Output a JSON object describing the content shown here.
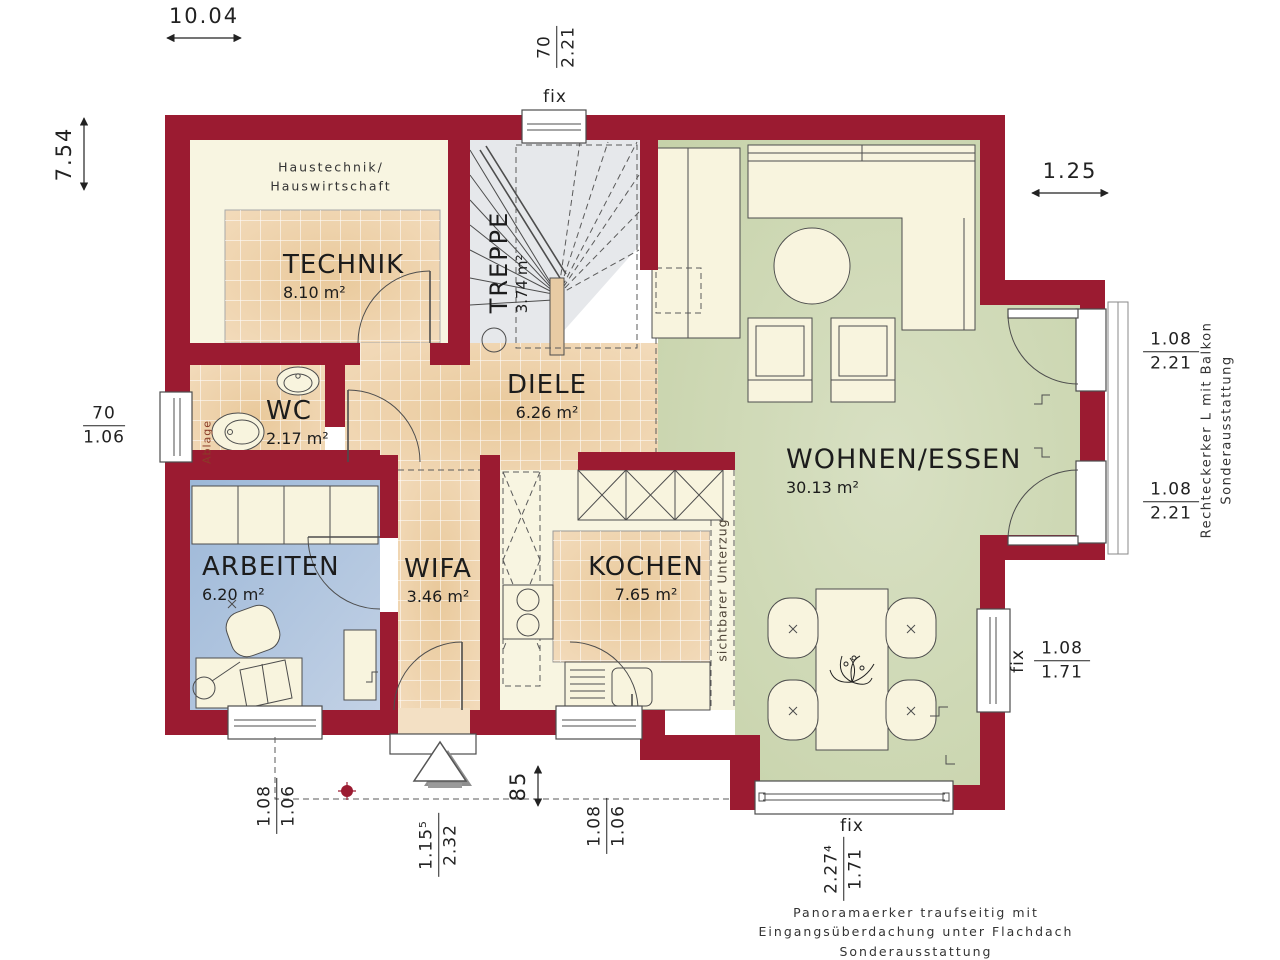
{
  "rooms": {
    "technik": {
      "name": "TECHNIK",
      "area": "8.10 m²"
    },
    "treppe": {
      "name": "TREPPE",
      "area": "3.74 m²"
    },
    "diele": {
      "name": "DIELE",
      "area": "6.26 m²"
    },
    "wc": {
      "name": "WC",
      "area": "2.17 m²"
    },
    "arbeiten": {
      "name": "ARBEITEN",
      "area": "6.20 m²"
    },
    "wifa": {
      "name": "WIFA",
      "area": "3.46 m²"
    },
    "kochen": {
      "name": "KOCHEN",
      "area": "7.65 m²"
    },
    "wohnen_essen": {
      "name": "WOHNEN/ESSEN",
      "area": "30.13 m²"
    }
  },
  "dimensions": {
    "total_width": "10.04",
    "total_height": "7.54",
    "bay_offset": "1.25",
    "overhang_depth": "85"
  },
  "openings": {
    "stair_window": {
      "label": "fix",
      "num": "70",
      "den": "2.21"
    },
    "wc_window": {
      "num": "70",
      "den": "1.06"
    },
    "bay_door_upper": {
      "num": "1.08",
      "den": "2.21"
    },
    "bay_door_lower": {
      "num": "1.08",
      "den": "2.21"
    },
    "living_window": {
      "label": "fix",
      "num": "1.08",
      "den": "1.71"
    },
    "arbeiten_window": {
      "num": "1.08",
      "den": "1.06"
    },
    "entry_door": {
      "num": "1.15⁵",
      "den": "2.32"
    },
    "kitchen_window": {
      "num": "1.08",
      "den": "1.06"
    },
    "panorama_window": {
      "label": "fix",
      "num": "2.27⁴",
      "den": "1.71"
    }
  },
  "annotations": {
    "technik_note": [
      "Haustechnik/",
      "Hauswirtschaft"
    ],
    "wc_note": "Ablage",
    "kitchen_note": "sichtbarer Unterzug",
    "bay_note": [
      "Rechteckerker L mit Balkon",
      "Sonderausstattung"
    ],
    "panorama_note": [
      "Panoramaerker traufseitig mit",
      "Eingangsüberdachung unter Flachdach",
      "Sonderausstattung"
    ]
  },
  "colors": {
    "wall": "#9b1b31",
    "tile": "#eed2ab",
    "cream": "#f8f5e1",
    "living_green": "#ccd7b1",
    "office_blue": "#a9c0dd",
    "stair_gray": "#e6e8eb"
  }
}
